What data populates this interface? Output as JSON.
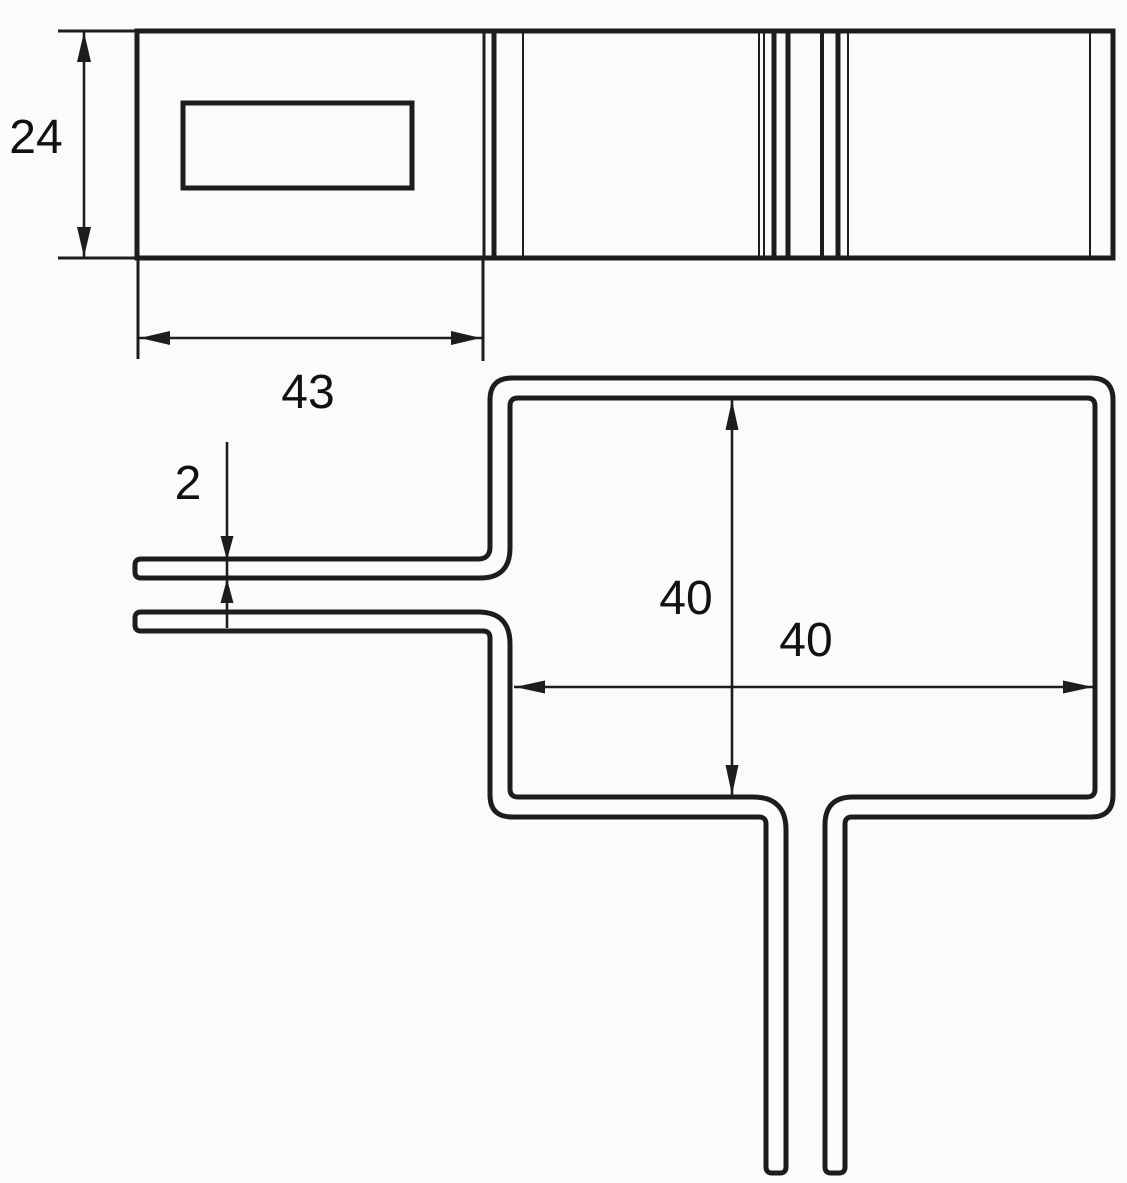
{
  "colors": {
    "background": "#fbfbfb",
    "line": "#1d1d1b",
    "text": "#111111"
  },
  "top_view": {
    "description": "profile strip with label window and bend lines",
    "dimensions": {
      "strip_height": {
        "label": "24",
        "orientation": "vertical"
      },
      "window_section_width": {
        "label": "43",
        "orientation": "horizontal"
      }
    }
  },
  "front_view": {
    "description": "bent wire frame with two left prongs and two bottom legs",
    "dimensions": {
      "wire_thickness": {
        "label": "2",
        "orientation": "vertical"
      },
      "frame_height": {
        "label": "40",
        "orientation": "vertical"
      },
      "frame_width": {
        "label": "40",
        "orientation": "horizontal"
      }
    }
  }
}
